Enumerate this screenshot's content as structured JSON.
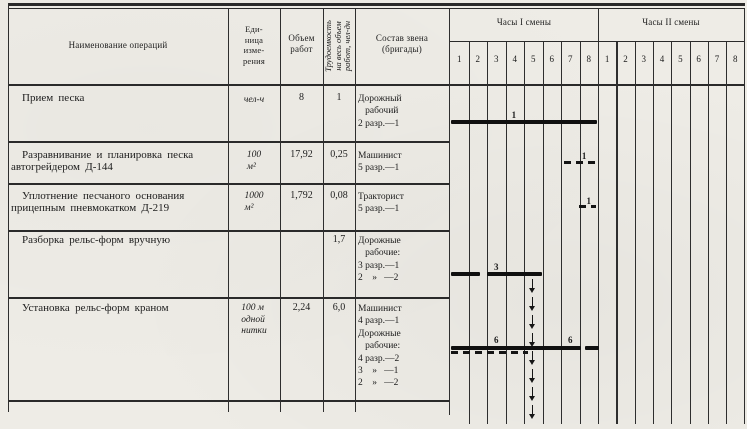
{
  "header": {
    "col_operations": "Наименование операций",
    "col_unit_lines": [
      "Еди-",
      "ница",
      "изме-",
      "рения"
    ],
    "col_volume_lines": [
      "Объем",
      "работ"
    ],
    "col_labor_lines": [
      "Трудоемкость",
      "на весь объем",
      "работ, чел-дн"
    ],
    "col_crew_lines": [
      "Состав звена",
      "(бригады)"
    ],
    "shift1_title": "Часы I смены",
    "shift2_title": "Часы II смены",
    "shift1_hours": [
      "1",
      "2",
      "3",
      "4",
      "5",
      "6",
      "7",
      "8"
    ],
    "shift2_hours": [
      "1",
      "2",
      "3",
      "4",
      "5",
      "6",
      "7",
      "8"
    ]
  },
  "rows": [
    {
      "name_lines": [
        "Прием песка"
      ],
      "unit_lines": [
        "чел-ч"
      ],
      "volume": "8",
      "labor": "1",
      "crew_lines": [
        "Дорожный",
        "   рабочий",
        "2 разр.—1"
      ]
    },
    {
      "name_lines": [
        "Разравнивание и планировка песка",
        "автогрейдером  Д-144"
      ],
      "unit_lines": [
        "100",
        "м²"
      ],
      "volume": "17,92",
      "labor": "0,25",
      "crew_lines": [
        "Машинист",
        "5 разр.—1"
      ]
    },
    {
      "name_lines": [
        "Уплотнение  песчаного  основания",
        "прицепным пневмокатком Д-219"
      ],
      "unit_lines": [
        "1000",
        "м²"
      ],
      "volume": "1,792",
      "labor": "0,08",
      "crew_lines": [
        "Тракторист",
        "5 разр.—1"
      ]
    },
    {
      "name_lines": [
        "Разборка рельс-форм вручную"
      ],
      "unit_lines": [],
      "volume": "",
      "labor": "1,7",
      "crew_lines": [
        "Дорожные",
        "   рабочие:",
        "3 разр.—1",
        "2    »   —2"
      ]
    },
    {
      "name_lines": [
        "Установка рельс-форм краном"
      ],
      "unit_lines": [
        "100 м",
        "одной",
        "нитки"
      ],
      "volume": "2,24",
      "labor": "6,0",
      "crew_lines": [
        "Машинист",
        "4 разр.—1",
        "Дорожные",
        "   рабочие:",
        "4 разр.—2",
        "3    »   —1",
        "2    »   —2"
      ]
    }
  ],
  "chart_data": {
    "type": "gantt",
    "title": "График выполнения операций по часам смен",
    "x_axis": "Часы I смены (1-8), Часы II смены (1-8)",
    "note": "Все работы выполняются в I смену; числа над линиями — количество рабочих",
    "bars": [
      {
        "op": "Прием песка",
        "style": "solid",
        "h0": 0.05,
        "h1": 7.95,
        "y": 122
      },
      {
        "op": "Разравнивание и планировка песка автогрейдером Д-144",
        "style": "dashed",
        "h0": 6.15,
        "h1": 7.88,
        "y": 163
      },
      {
        "op": "Уплотнение песчаного основания пневмокатком Д-219",
        "style": "dashed",
        "h0": 6.95,
        "h1": 7.88,
        "y": 207
      },
      {
        "op": "Разборка рельс-форм вручную",
        "style": "solid",
        "h0": 0.05,
        "h1": 1.62,
        "y": 274
      },
      {
        "op": "Разборка рельс-форм вручную",
        "style": "solid",
        "h0": 2.02,
        "h1": 4.97,
        "y": 274
      },
      {
        "op": "Установка рельс-форм краном",
        "style": "solid",
        "h0": 0.05,
        "h1": 7.08,
        "y": 348
      },
      {
        "op": "Установка рельс-форм краном",
        "style": "solid",
        "h0": 7.3,
        "h1": 8.05,
        "y": 348
      },
      {
        "op": "Установка рельс-форм краном",
        "style": "dashed",
        "h0": 0.05,
        "h1": 4.2,
        "y": 353
      }
    ],
    "labels": [
      {
        "text": "1",
        "h": 3.45,
        "y": 110
      },
      {
        "text": "1",
        "h": 7.25,
        "y": 151
      },
      {
        "text": "1",
        "h": 7.5,
        "y": 196
      },
      {
        "text": "3",
        "h": 2.5,
        "y": 262
      },
      {
        "text": "6",
        "h": 2.5,
        "y": 335
      },
      {
        "text": "6",
        "h": 6.5,
        "y": 335
      }
    ],
    "arrow": {
      "h": 4.45,
      "y0": 279,
      "y1": 424
    }
  }
}
